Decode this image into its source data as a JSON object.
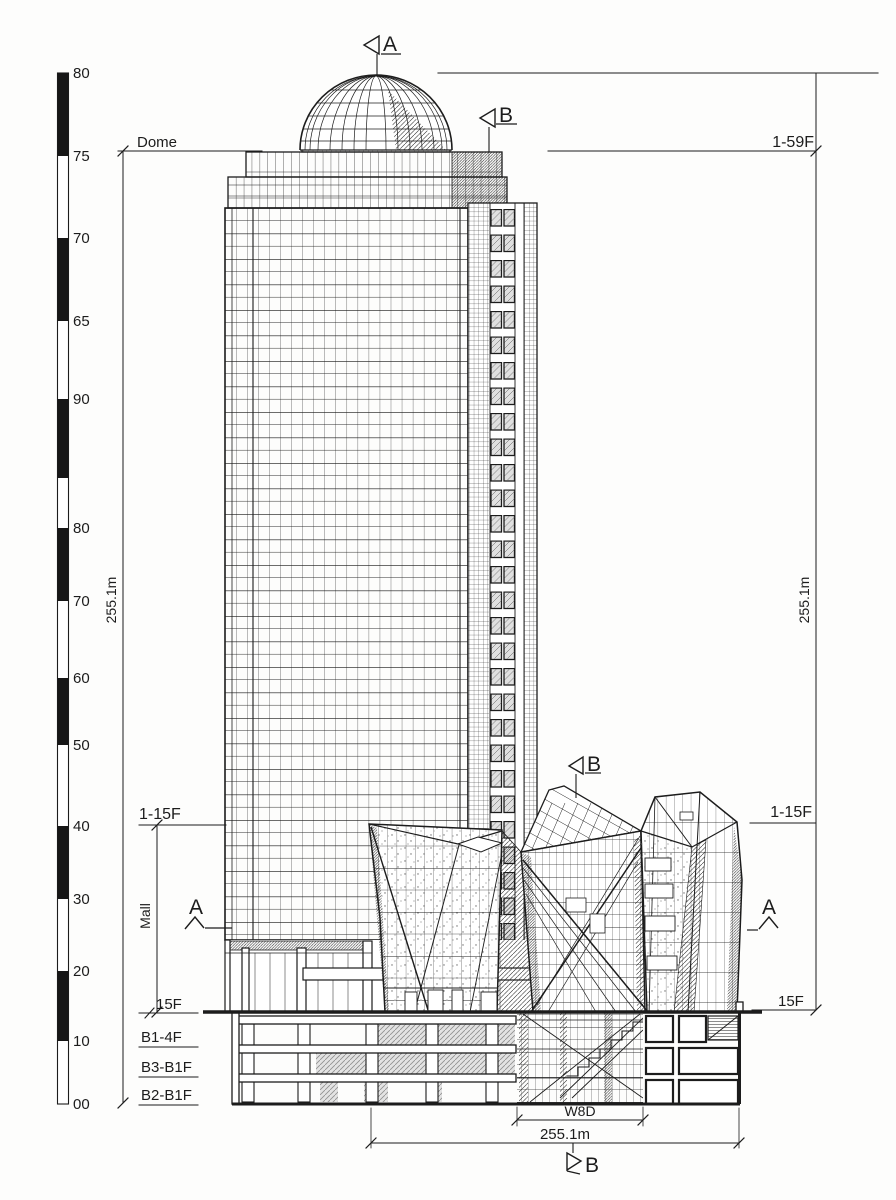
{
  "page": {
    "background": "#fdfdfc",
    "ink": "#1c1c1c",
    "hatch_gray": "#e3e3e3"
  },
  "scale_bar": {
    "labels": [
      "80",
      "75",
      "70",
      "65",
      "90",
      "80",
      "70",
      "60",
      "50",
      "40",
      "30",
      "20",
      "10",
      "00"
    ]
  },
  "dimensions": {
    "dome_level": "Dome",
    "tower_floors": "1-59F",
    "height_left": "255.1m",
    "height_right": "255.1m",
    "podium_floors_left": "1-15F",
    "podium_floors_right": "1-15F",
    "mall_label": "Mall",
    "ground_level_left": "15F",
    "ground_level_right": "15F",
    "basement_b1_4f": "B1-4F",
    "basement_b3_b1f": "B3-B1F",
    "basement_b2_b1f": "B2-B1F",
    "overall_width": "255.1m",
    "core_width": "W8D"
  },
  "section_markers": {
    "a": "A",
    "b": "B"
  }
}
